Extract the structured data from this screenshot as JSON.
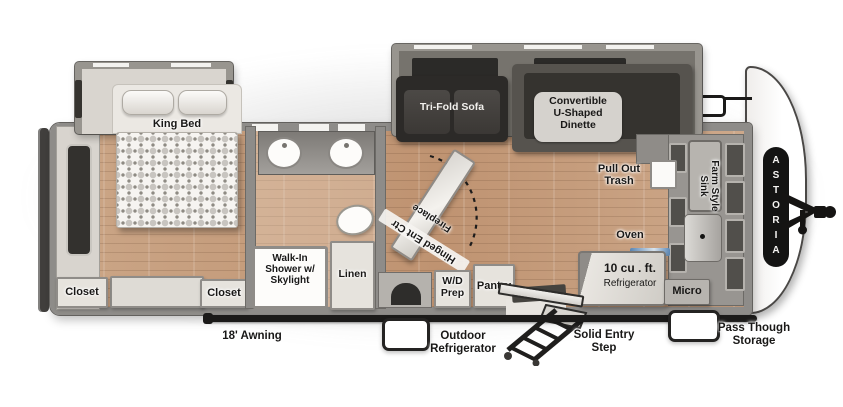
{
  "plan": {
    "brand": "ASTORIA",
    "labels": {
      "king_bed": "King Bed",
      "closet_left": "Closet",
      "closet_right": "Closet",
      "shower": "Walk-In\nShower w/\nSkylight",
      "linen": "Linen",
      "tri_fold_sofa": "Tri-Fold Sofa",
      "dinette": "Convertible\nU-Shaped\nDinette",
      "fireplace": "Fireplace",
      "hinged_ent_ctr": "Hinged Ent Ctr",
      "pull_out_trash": "Pull Out\nTrash",
      "farm_sink": "Farm Style\nSink",
      "oven": "Oven",
      "fridge_size": "10 cu . ft.",
      "fridge_name": "Refrigerator",
      "micro": "Micro",
      "pantry": "Pantry",
      "wd_prep": "W/D\nPrep",
      "awning": "18' Awning",
      "outdoor_fridge": "Outdoor\nRefrigerator",
      "entry_step": "Solid Entry\nStep",
      "pass_through": "Pass Though\nStorage"
    },
    "colors": {
      "floor_wood": "#c79e7e",
      "wall_gray": "#8e8c89",
      "slide_interior": "#d9d5cf",
      "dark_furniture": "#2f2d2b",
      "label_bg": "#d5d2cd",
      "badge_black": "#141413",
      "accent_blue": "#5b87b5"
    }
  }
}
